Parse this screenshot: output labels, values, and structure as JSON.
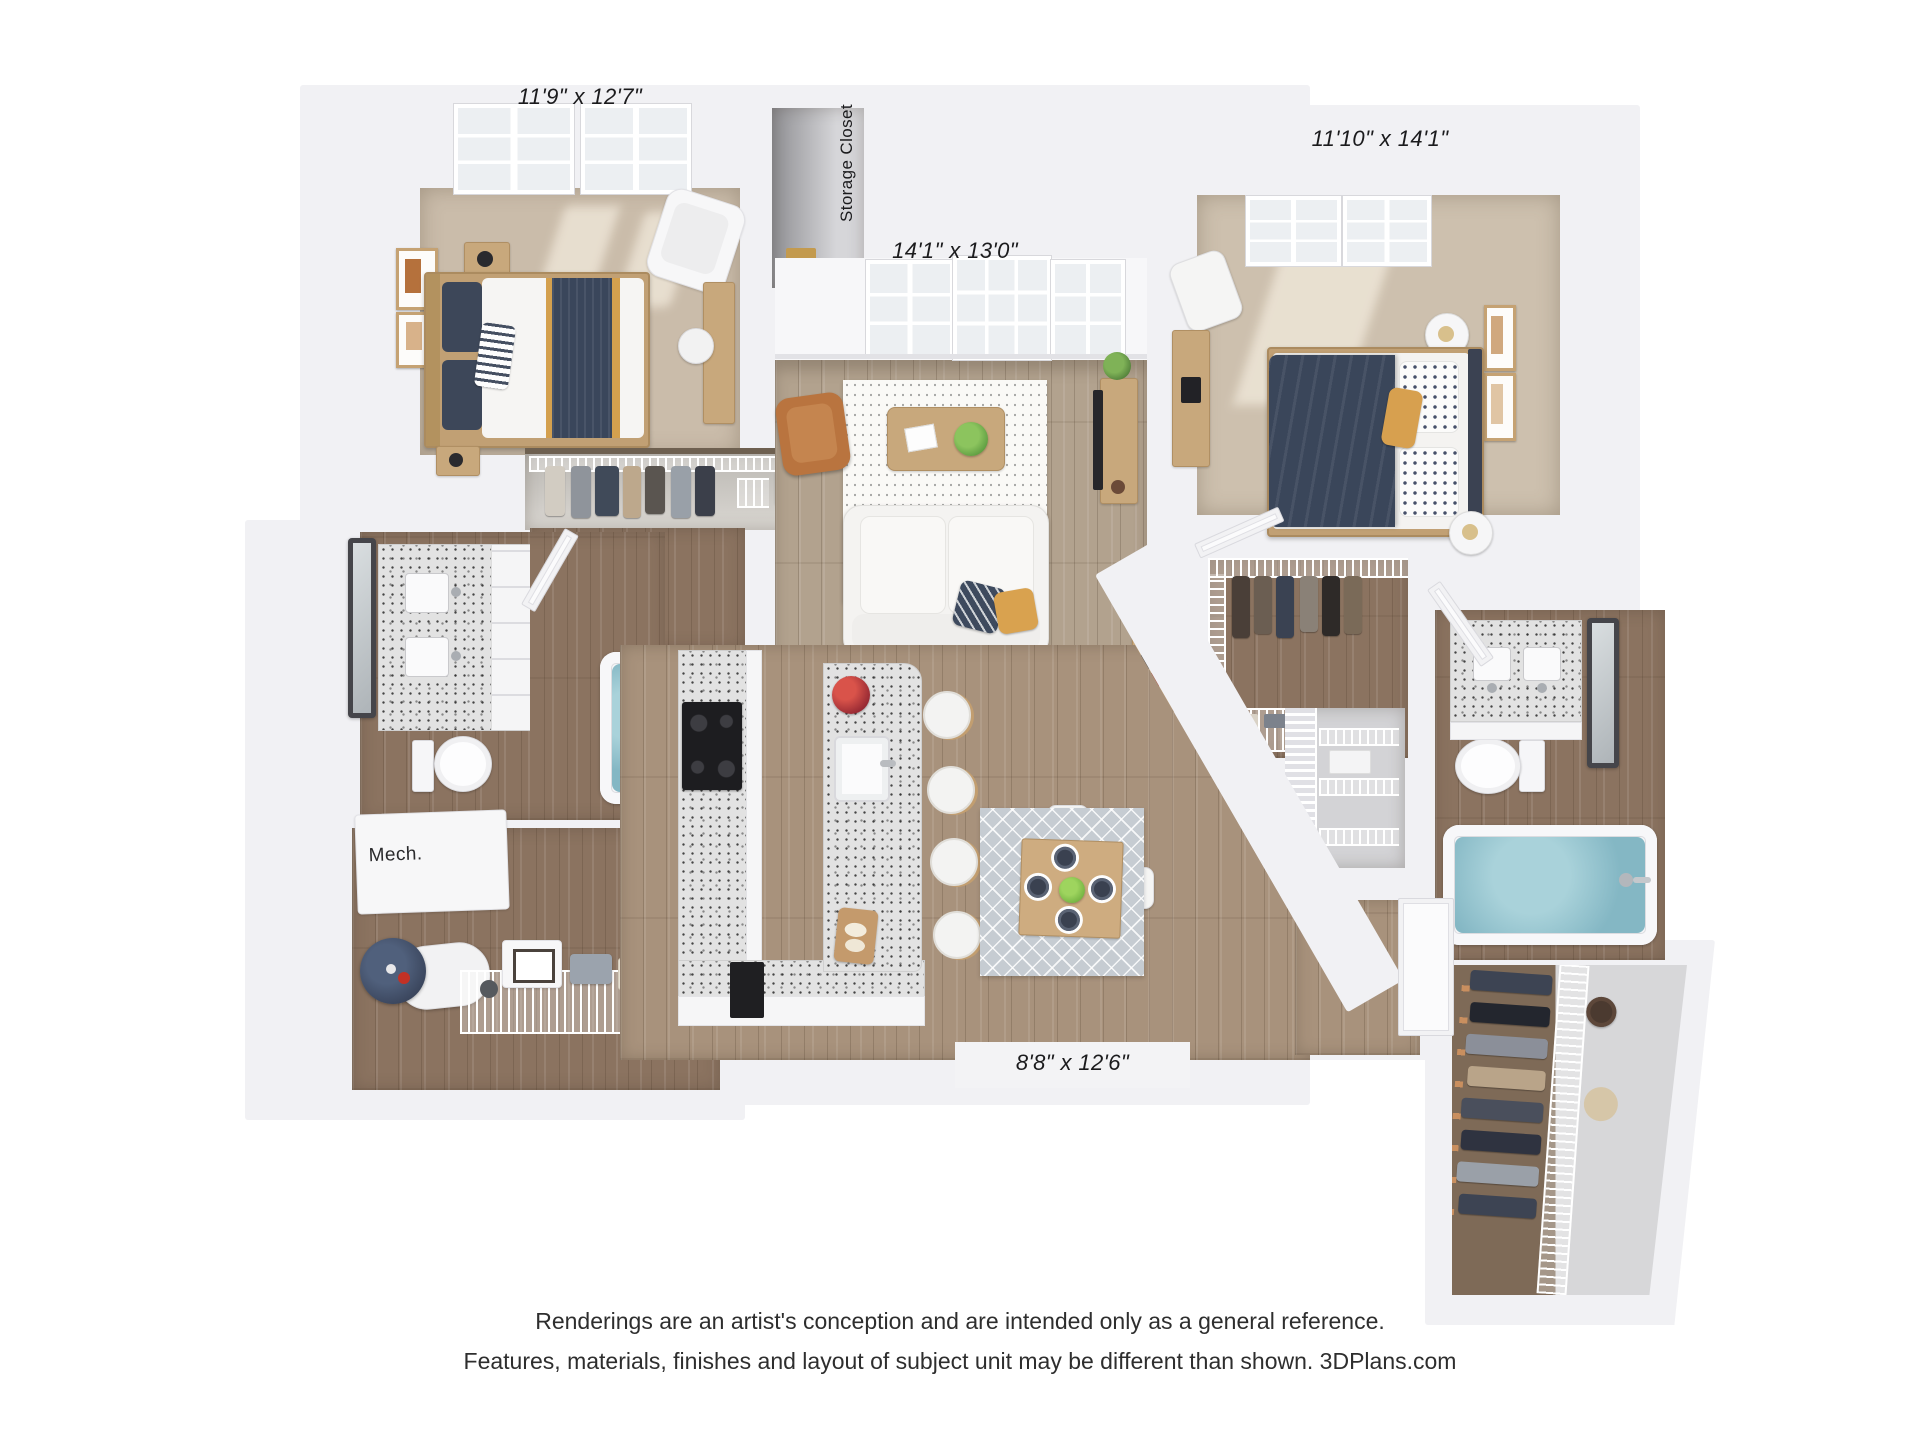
{
  "palette": {
    "wall": "#f1f1f4",
    "wood_floor": "#a8927c",
    "carpet": "#cabcaa",
    "granite": "#e2e2e2",
    "bedding_navy": "#3a465a",
    "accent_mustard": "#d7a04f",
    "leather_tan": "#b9743f",
    "tub_water": "#84b7c4",
    "rug_dining": "#c6ccd2",
    "rug_living": "#faf9f6"
  },
  "rooms": {
    "bedroom1": {
      "dimensions": "11'9\" x 12'7\""
    },
    "bedroom2": {
      "dimensions": "11'10\" x 14'1\""
    },
    "living": {
      "dimensions": "14'1\" x 13'0\""
    },
    "dining": {
      "dimensions": "8'8\" x 12'6\""
    },
    "storage_closet": {
      "label": "Storage Closet"
    },
    "mechanical": {
      "label": "Mech."
    }
  },
  "footer": {
    "line1": "Renderings are an artist's conception and are intended only as a general reference.",
    "line2": "Features, materials, finishes and layout of subject unit may be different than shown. 3DPlans.com"
  }
}
